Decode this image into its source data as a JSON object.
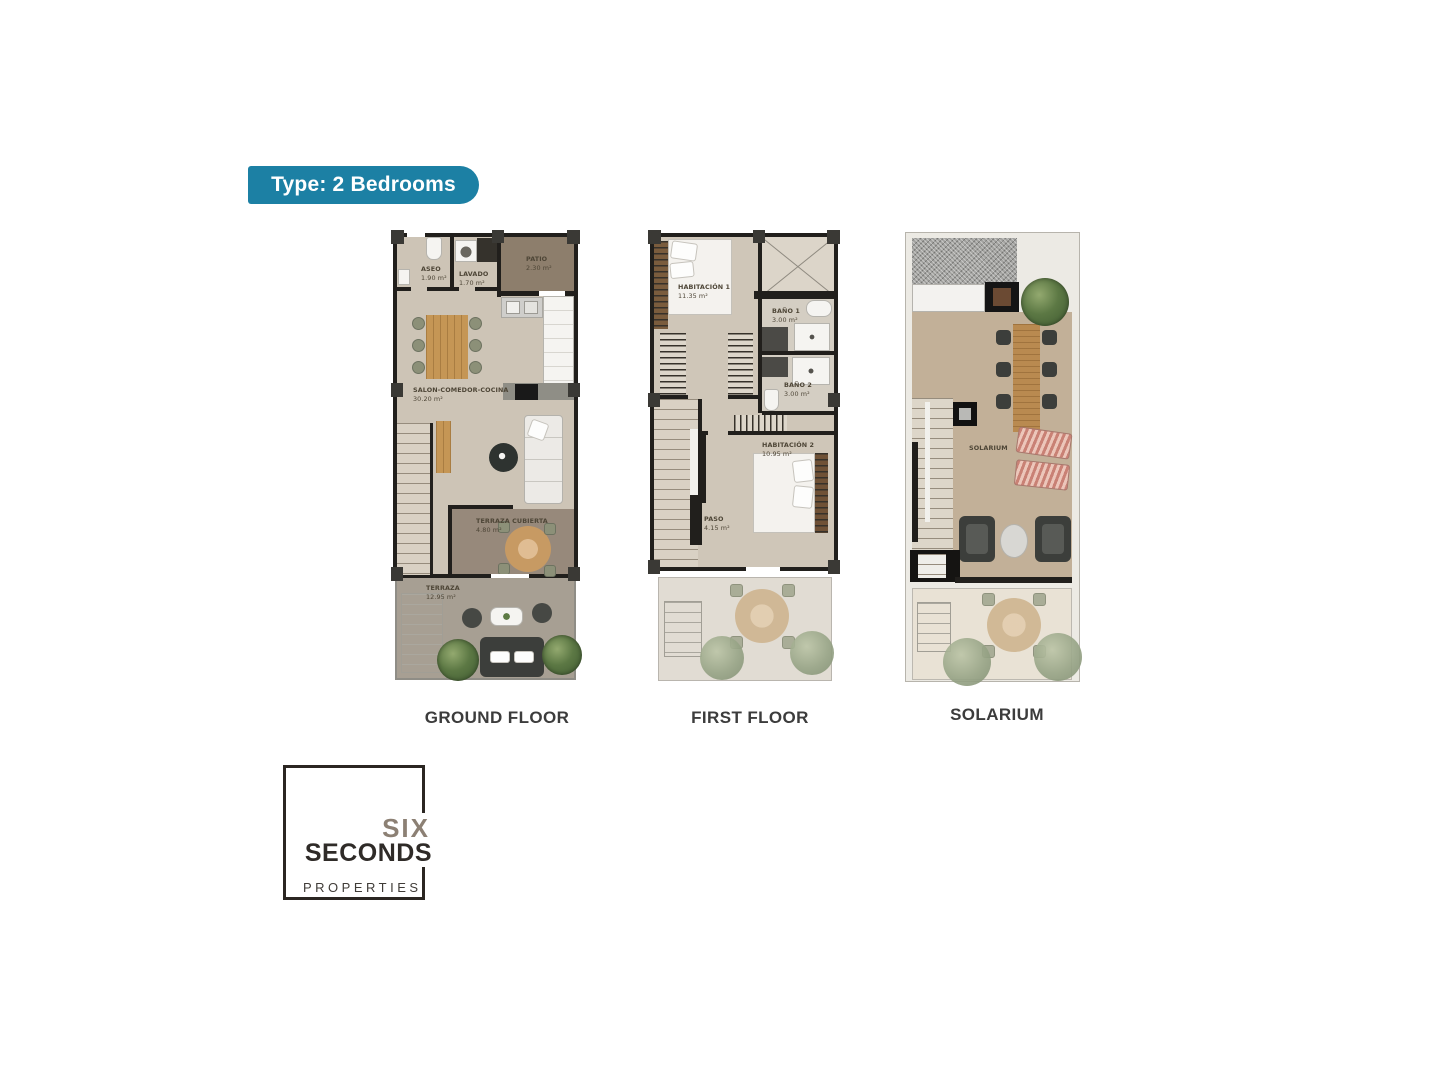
{
  "badge": {
    "label": "Type: 2 Bedrooms"
  },
  "floors": {
    "ground": {
      "title": "GROUND FLOOR",
      "rooms": {
        "aseo": {
          "name": "ASEO",
          "area": "1.90 m²"
        },
        "lavado": {
          "name": "LAVADO",
          "area": "1.70 m²"
        },
        "patio": {
          "name": "PATIO",
          "area": "2.30 m²"
        },
        "salon": {
          "name": "SALON-COMEDOR-COCINA",
          "area": "30.20 m²"
        },
        "terraza_cubierta": {
          "name": "TERRAZA CUBIERTA",
          "area": "4.80 m²"
        },
        "terraza": {
          "name": "TERRAZA",
          "area": "12.95 m²"
        }
      }
    },
    "first": {
      "title": "FIRST FLOOR",
      "rooms": {
        "habitacion1": {
          "name": "HABITACIÓN 1",
          "area": "11.35 m²"
        },
        "bano1": {
          "name": "BAÑO 1",
          "area": "3.00 m²"
        },
        "bano2": {
          "name": "BAÑO 2",
          "area": "3.00 m²"
        },
        "habitacion2": {
          "name": "HABITACIÓN 2",
          "area": "10.95 m²"
        },
        "paso": {
          "name": "PASO",
          "area": "4.15 m²"
        }
      }
    },
    "solarium": {
      "title": "SOLARIUM",
      "rooms": {
        "solarium": {
          "name": "SOLARIUM"
        }
      }
    }
  },
  "logo": {
    "word_top": "SIX",
    "word_mid": "SECONDS",
    "word_bottom": "PROPERTIES"
  },
  "colors": {
    "badge_bg": "#1c80a4",
    "wall": "#211f1c",
    "floor_beige": "#cdc4b6",
    "patio_brown": "#8d7e6c",
    "covered_terrace": "#97897b",
    "terrace_gray": "#a79f93",
    "solarium_floor": "#c2b098",
    "title_text": "#3c3c3c",
    "logo_accent": "#8c8074"
  }
}
